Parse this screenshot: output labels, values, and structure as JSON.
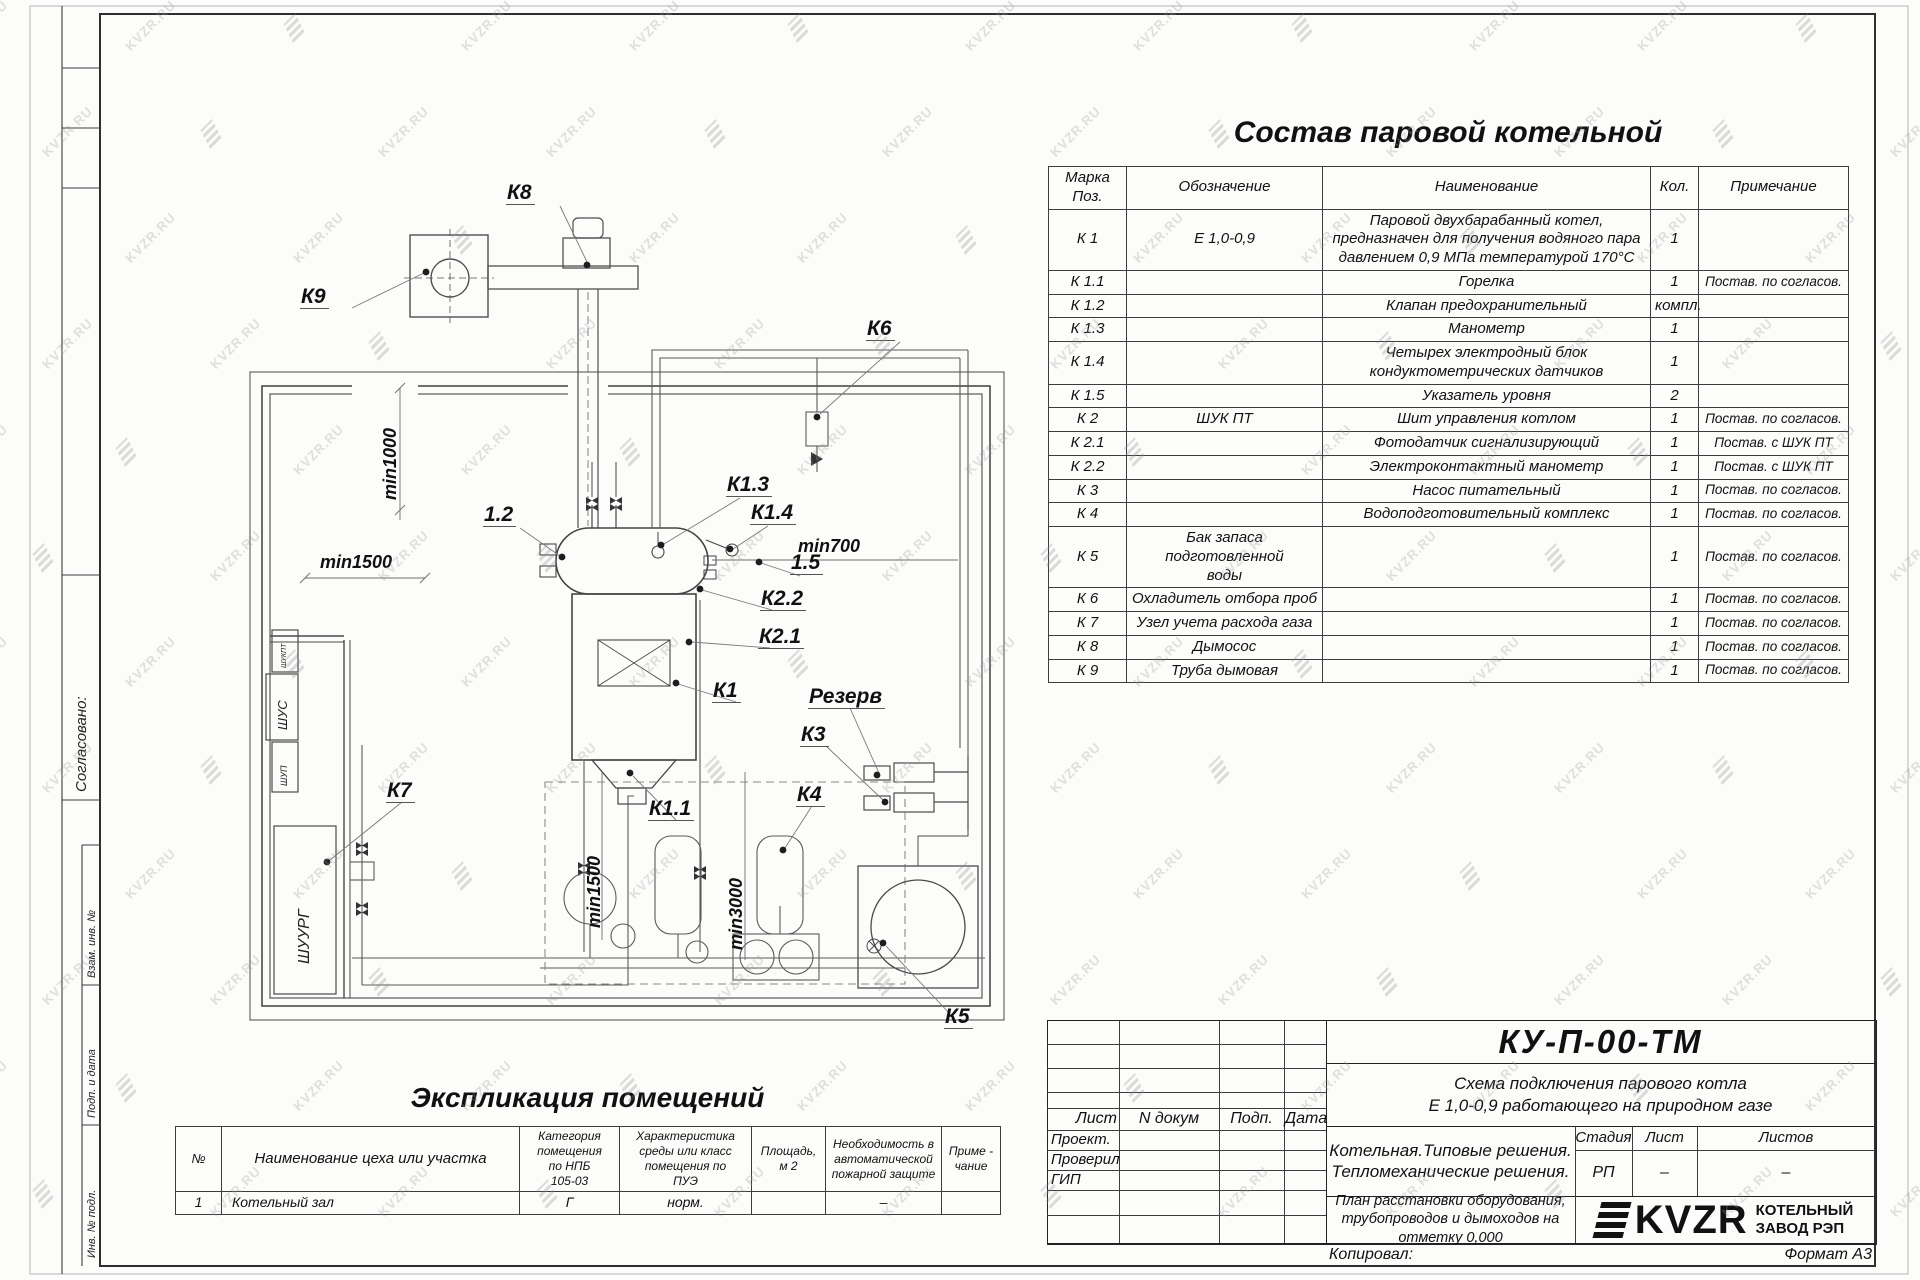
{
  "watermark": {
    "text": "KVZR.RU"
  },
  "margin": {
    "sogl": "Согласовано:",
    "vzam": "Взам. инв. №",
    "podp_data": "Подп. и дата",
    "inv_podl": "Инв. № подл."
  },
  "components_table": {
    "title": "Состав паровой котельной",
    "headers": {
      "mark": "Марка\nПоз.",
      "designation": "Обозначение",
      "name": "Наименование",
      "qty": "Кол.",
      "note": "Примечание"
    },
    "rows": [
      {
        "mark": "К 1",
        "designation": "Е  1,0-0,9",
        "name": "Паровой двухбарабанный котел,\nпредназначен для получения водяного пара\nдавлением 0,9 МПа температурой 170°С",
        "qty": "1",
        "note": ""
      },
      {
        "mark": "К 1.1",
        "designation": "",
        "name": "Горелка",
        "qty": "1",
        "note": "Постав. по согласов."
      },
      {
        "mark": "К 1.2",
        "designation": "",
        "name": "Клапан предохранительный",
        "qty": "компл.",
        "note": ""
      },
      {
        "mark": "К 1.3",
        "designation": "",
        "name": "Манометр",
        "qty": "1",
        "note": ""
      },
      {
        "mark": "К 1.4",
        "designation": "",
        "name": "Четырех электродный блок\nкондуктометрических датчиков",
        "qty": "1",
        "note": ""
      },
      {
        "mark": "К 1.5",
        "designation": "",
        "name": "Указатель уровня",
        "qty": "2",
        "note": ""
      },
      {
        "mark": "К 2",
        "designation": "ШУК ПТ",
        "name": "Шит управления котлом",
        "qty": "1",
        "note": "Постав. по согласов."
      },
      {
        "mark": "К 2.1",
        "designation": "",
        "name": "Фотодатчик сигнализирующий",
        "qty": "1",
        "note": "Постав. с ШУК ПТ"
      },
      {
        "mark": "К 2.2",
        "designation": "",
        "name": "Электроконтактный манометр",
        "qty": "1",
        "note": "Постав. с ШУК ПТ"
      },
      {
        "mark": "К 3",
        "designation": "",
        "name": "Насос питательный",
        "qty": "1",
        "note": "Постав. по согласов."
      },
      {
        "mark": "К 4",
        "designation": "",
        "name": "Водоподготовительный комплекс",
        "qty": "1",
        "note": "Постав. по согласов."
      },
      {
        "mark": "К 5",
        "designation": "Бак запаса подготовленной\nводы",
        "name": "",
        "qty": "1",
        "note": "Постав. по согласов."
      },
      {
        "mark": "К 6",
        "designation": "Охладитель отбора проб",
        "name": "",
        "qty": "1",
        "note": "Постав. по согласов."
      },
      {
        "mark": "К 7",
        "designation": "Узел учета расхода газа",
        "name": "",
        "qty": "1",
        "note": "Постав. по согласов."
      },
      {
        "mark": "К 8",
        "designation": "Дымосос",
        "name": "",
        "qty": "1",
        "note": "Постав. по согласов."
      },
      {
        "mark": "К 9",
        "designation": "Труба дымовая",
        "name": "",
        "qty": "1",
        "note": "Постав. по согласов."
      }
    ]
  },
  "explication_table": {
    "title": "Экспликация помещений",
    "headers": [
      "№",
      "Наименование цеха или участка",
      "Категория\nпомещения\nпо НПБ\n105-03",
      "Характеристика\nсреды или класс\nпомещения по\nПУЭ",
      "Площадь,\nм 2",
      "Необходимость в\nавтоматической\nпожарной защите",
      "Приме -\nчание"
    ],
    "row": {
      "num": "1",
      "name": "Котельный зал",
      "category": "Г",
      "env": "норм.",
      "area": "",
      "fire": "–",
      "note": ""
    }
  },
  "title_block": {
    "doc_code": "КУ-П-00-ТМ",
    "doc_title": "Схема подключения парового котла\nЕ 1,0-0,9 работающего на природном газе",
    "col_list": "Лист",
    "col_ndoc": "N докум",
    "col_sign": "Подп.",
    "col_date": "Дата",
    "role_1": "Проект.",
    "role_2": "Проверил",
    "role_3": "ГИП",
    "object_lines": "Котельная.Типовые решения.\nТепломеханические решения.",
    "stage_h": "Стадия",
    "sheet_h": "Лист",
    "sheets_h": "Листов",
    "stage_v": "РП",
    "sheet_v": "–",
    "sheets_v": "–",
    "sheet_title": "План расстановки оборудования,\nтрубопроводов и дымоходов на\nотметку 0,000",
    "logo_text": "KVZR",
    "company": "КОТЕЛЬНЫЙ\nЗАВОД РЭП",
    "copied_label": "Копировал:",
    "format_label": "Формат А3"
  },
  "diagram": {
    "labels": {
      "k8": "К8",
      "k9": "К9",
      "k6": "К6",
      "p1_2": "1.2",
      "k1_3": "К1.3",
      "k1_4": "К1.4",
      "p1_5": "1.5",
      "k2_2": "К2.2",
      "k2_1": "К2.1",
      "k1": "К1",
      "rezerv": "Резерв",
      "k3": "К3",
      "k4": "К4",
      "k5": "К5",
      "k7": "К7",
      "k1_1": "К1.1"
    },
    "dimensions": {
      "d_min1000": "min1000",
      "d_min1500a": "min1500",
      "d_min700": "min700",
      "d_min1500b": "min1500",
      "d_min3000": "min3000"
    },
    "cabinets": {
      "c1": "ШУКПТ",
      "c2": "ШУС",
      "c3": "ШУП",
      "c4": "ШУУРГ"
    }
  }
}
